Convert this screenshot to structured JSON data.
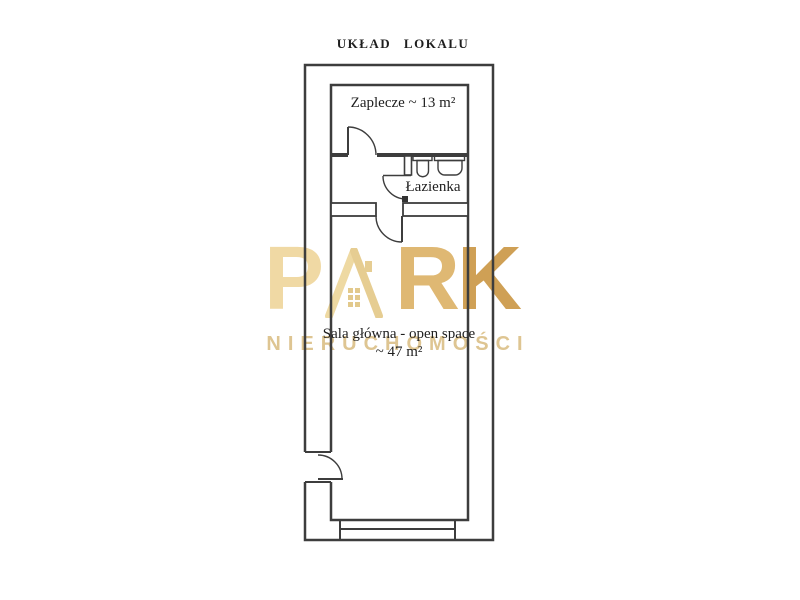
{
  "title": "UKŁAD LOKALU",
  "plan": {
    "line_color": "#3d3d3d",
    "rooms": {
      "zaplecze": {
        "label": "Zaplecze ~ 13 m²",
        "area_m2": 13
      },
      "lazienka": {
        "label": "Łazienka"
      },
      "sala_glowna": {
        "label_line1": "Sala główna - open space",
        "label_line2": "~ 47 m²",
        "area_m2": 47
      }
    },
    "fixtures": [
      "toilet-icon",
      "sink-icon"
    ],
    "doors": [
      "entrance-door",
      "zaplecze-door",
      "bathroom-door",
      "hall-door"
    ]
  },
  "watermark": {
    "brand_letter_p": "P",
    "brand_letter_r": "R",
    "brand_letter_k": "K",
    "brand_house_icon": "house-a-icon",
    "subtitle": "NIERUCHOMOŚCI",
    "colors": {
      "letter_p": "#f0d9a4",
      "letter_r": "#dfb873",
      "letter_k": "#cfa055",
      "subtitle": "#d9bc7f"
    }
  }
}
